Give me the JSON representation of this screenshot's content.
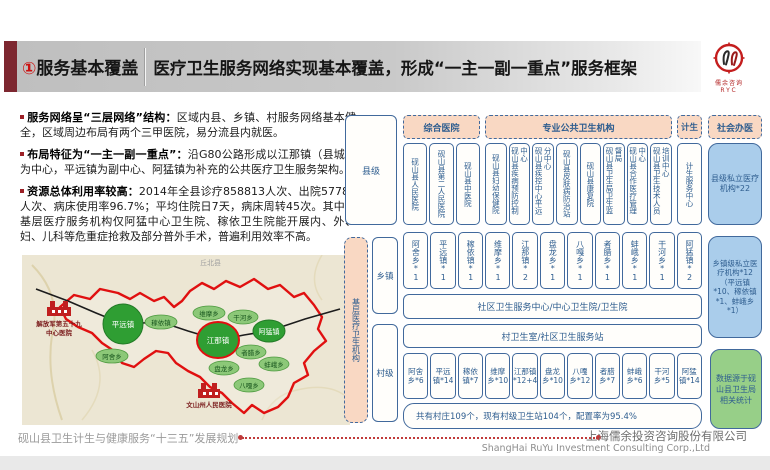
{
  "header": {
    "number": "①",
    "section": "服务基本覆盖",
    "title": "医疗卫生服务网络实现基本覆盖，形成“一主一副一重点”服务框架"
  },
  "logo": {
    "name_cn": "儒余咨询",
    "name_en": "RYC"
  },
  "bullets": [
    {
      "lead": "服务网络呈“三层网络”结构：",
      "body": "区域内县、乡镇、村服务网络基本健全，区域周边布局有两个三甲医院，易分流县内就医。"
    },
    {
      "lead": "布局特征为“一主一副一重点”：",
      "body": "沿G80公路形成以江那镇（县城）为中心，平远镇为副中心、阿猛镇为补充的公共医疗卫生服务架构。"
    },
    {
      "lead": "资源总体利用率较高：",
      "body": "2014年全县诊疗858813人次、出院57781人次、病床使用率96.7%；平均住院日7天，病床周转45次。其中，基层医疗服务机构仅阿猛中心卫生院、稼依卫生院能开展内、外、妇、儿科等危重症抢救及部分普外手术，普遍利用效率不高。"
    }
  ],
  "map": {
    "region_label": "丘北县",
    "hospital_west": [
      "解放军第五十九",
      "中心医院"
    ],
    "hospital_south": "文山州人民医院",
    "major_towns": [
      "平远镇",
      "江那镇",
      "阿猛镇"
    ],
    "towns": [
      "稼依镇",
      "阿舍乡",
      "维摩乡",
      "干河乡",
      "者腊乡",
      "蚌峨乡",
      "盘龙乡",
      "八嘎乡"
    ]
  },
  "diagram": {
    "levels": {
      "county": "县级",
      "primary": "基层医疗卫生机构",
      "township": "乡镇",
      "village": "村级"
    },
    "headers": {
      "general": "综合医院",
      "public": "专业公共卫生机构",
      "family": "计生",
      "social": "社会办医"
    },
    "county": {
      "general_items": [
        "砚山县人民医院",
        "砚山县第二人民医院",
        "砚山县中医院"
      ],
      "public_items": [
        "砚山县妇幼保健院",
        "砚山县疾病预防控制中心",
        "砚山县疾控中心平远分中心",
        "砚山县皮肤病防治站",
        "砚山县康复院",
        "砚山县卫生局卫生监督局",
        "砚山县合作医疗管理中心",
        "砚山县卫生技术人员培训中心"
      ],
      "family_items": [
        "计生服务中心"
      ],
      "private": "县级私立医疗机构*22"
    },
    "township": {
      "items": [
        "阿舍乡*1",
        "平远镇*1",
        "稼依镇*1",
        "维摩乡*1",
        "江那镇*2",
        "盘龙乡*1",
        "八嘎乡*1",
        "者腊乡*1",
        "蚌峨乡*1",
        "干河乡*1",
        "阿猛镇*2"
      ],
      "band": "社区卫生服务中心/中心卫生院/卫生院",
      "private": "乡镇级私立医疗机构*12（平远镇*10、稼依镇*1、蚌峨乡*1）"
    },
    "village": {
      "band": "村卫生室/社区卫生服务站",
      "items": [
        "阿舍乡*6",
        "平远镇*14",
        "稼依镇*7",
        "维摩乡*10",
        "江那镇*12+4",
        "盘龙乡*10",
        "八嘎乡*12",
        "者腊乡*7",
        "蚌峨乡*6",
        "干河乡*5",
        "阿猛镇*14"
      ],
      "note": "共有村庄109个，现有村级卫生站104个，配置率为95.4%"
    },
    "source_note": "数据源于砚山县卫生局相关统计"
  },
  "footer": {
    "left": "砚山县卫生计生与健康服务“十三五”发展规划",
    "company_cn": "上海儒余投资咨询股份有限公司",
    "company_en": "ShangHai RuYu Investment Consulting Corp.,Ltd"
  },
  "colors": {
    "accent_red": "#b01f24",
    "diagram_blue": "#41699c",
    "peach": "#f9d8c3",
    "light_blue": "#aacdeb",
    "light_green": "#97cf88",
    "map_green": "#2f9e33"
  }
}
